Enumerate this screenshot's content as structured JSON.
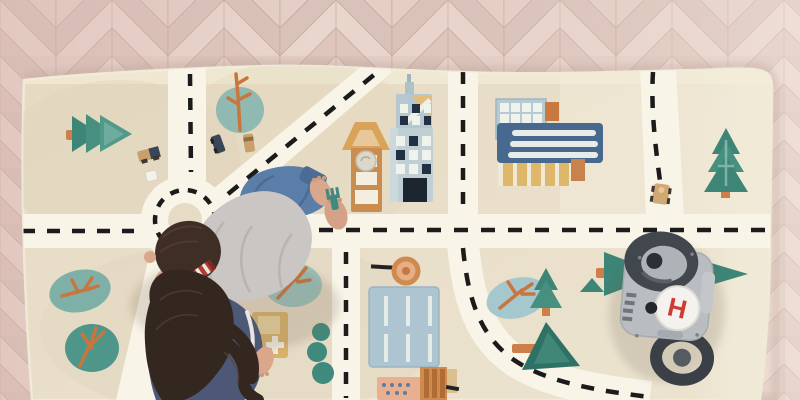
{
  "scene": {
    "view": "top-down",
    "description": "Two children playing on a beige city road-map play rug laid over a pale herringbone wood floor, with wooden toy cars, wooden blocks and a grey helicopter-pad garage toy"
  },
  "floor": {
    "material": "herringbone-wood",
    "plank_colors": [
      "#e9d6cd",
      "#dec6bd",
      "#e4cfc6",
      "#d9c2b9"
    ]
  },
  "rug": {
    "type": "city-road-play-rug",
    "base_color": "#e8ddc7",
    "road_color": "#f8f4e8",
    "dash_color": "#1b1b1b",
    "landmarks": [
      "roundabout",
      "skyscraper",
      "watch-tower",
      "office-building",
      "hospital",
      "parking-lot",
      "market",
      "round-trees",
      "pine-trees",
      "street-sign"
    ]
  },
  "children": [
    {
      "id": "boy",
      "pose": "crawling",
      "top_color": "#c9c6c3",
      "pants_color": "#5a7ea8",
      "hair_color": "#3f2e26"
    },
    {
      "id": "girl",
      "pose": "sitting",
      "top_color": "#4d5877",
      "hair_color": "#33271f"
    }
  ],
  "toys": {
    "helipad": {
      "letter": "H",
      "letter_color": "#cf3a31",
      "body_color": "#b9bdc1",
      "pad_color": "#f3f2ee"
    },
    "wooden_cars_count": "4",
    "blocks_count": "2"
  }
}
